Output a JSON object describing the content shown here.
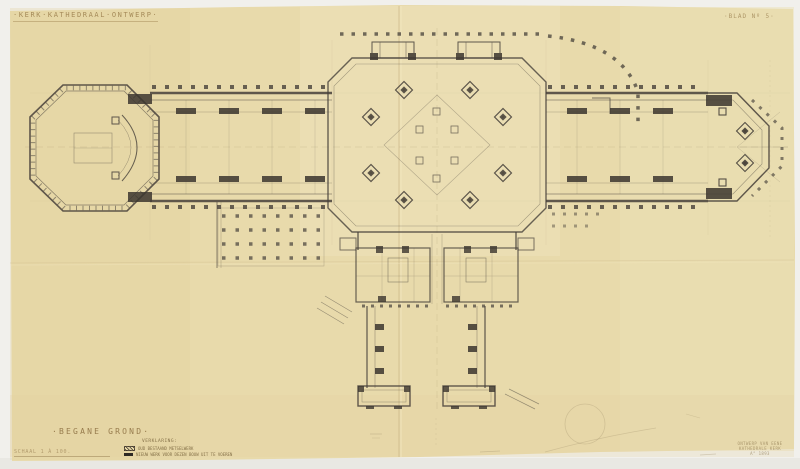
{
  "document": {
    "title": "·KERK·KATHEDRAAL·ONTWERP·",
    "sheet_label": "·BLAD Nº 5·",
    "floor_label": "·BEGANE GROND·",
    "scale_label": "SCHAAL 1 À 100.",
    "legend": {
      "heading": "VERKLARING:",
      "items": [
        {
          "swatch": "hatched",
          "label": "OUD BESTAAND METSELWERK"
        },
        {
          "swatch": "solid",
          "label": "NIEUW WERK VOOR DEZEN BOUW UIT TE VOEREN"
        }
      ]
    },
    "signature_block": {
      "line1": "ONTWERP VAN EENE",
      "line2": "KATHEDRALE KERK",
      "line3": "A° 1893"
    }
  },
  "plan": {
    "subject": "Cruciform cathedral ground-floor plan: octagonal west tower, colonnaded nave, large octagonal crossing, polygonal east apse, southern sacristy wing with cloister court and corner pavilions",
    "media": "black ink on yellowed folded tracing paper"
  },
  "colors": {
    "backdrop": "#f1f0ec",
    "paper": "#e8daab",
    "paper_light": "#f0e5c0",
    "ink": "#3f3a33",
    "faint_ink": "#a08e66",
    "crease": "#c9b484",
    "legend_solid": "#2e2a24"
  }
}
